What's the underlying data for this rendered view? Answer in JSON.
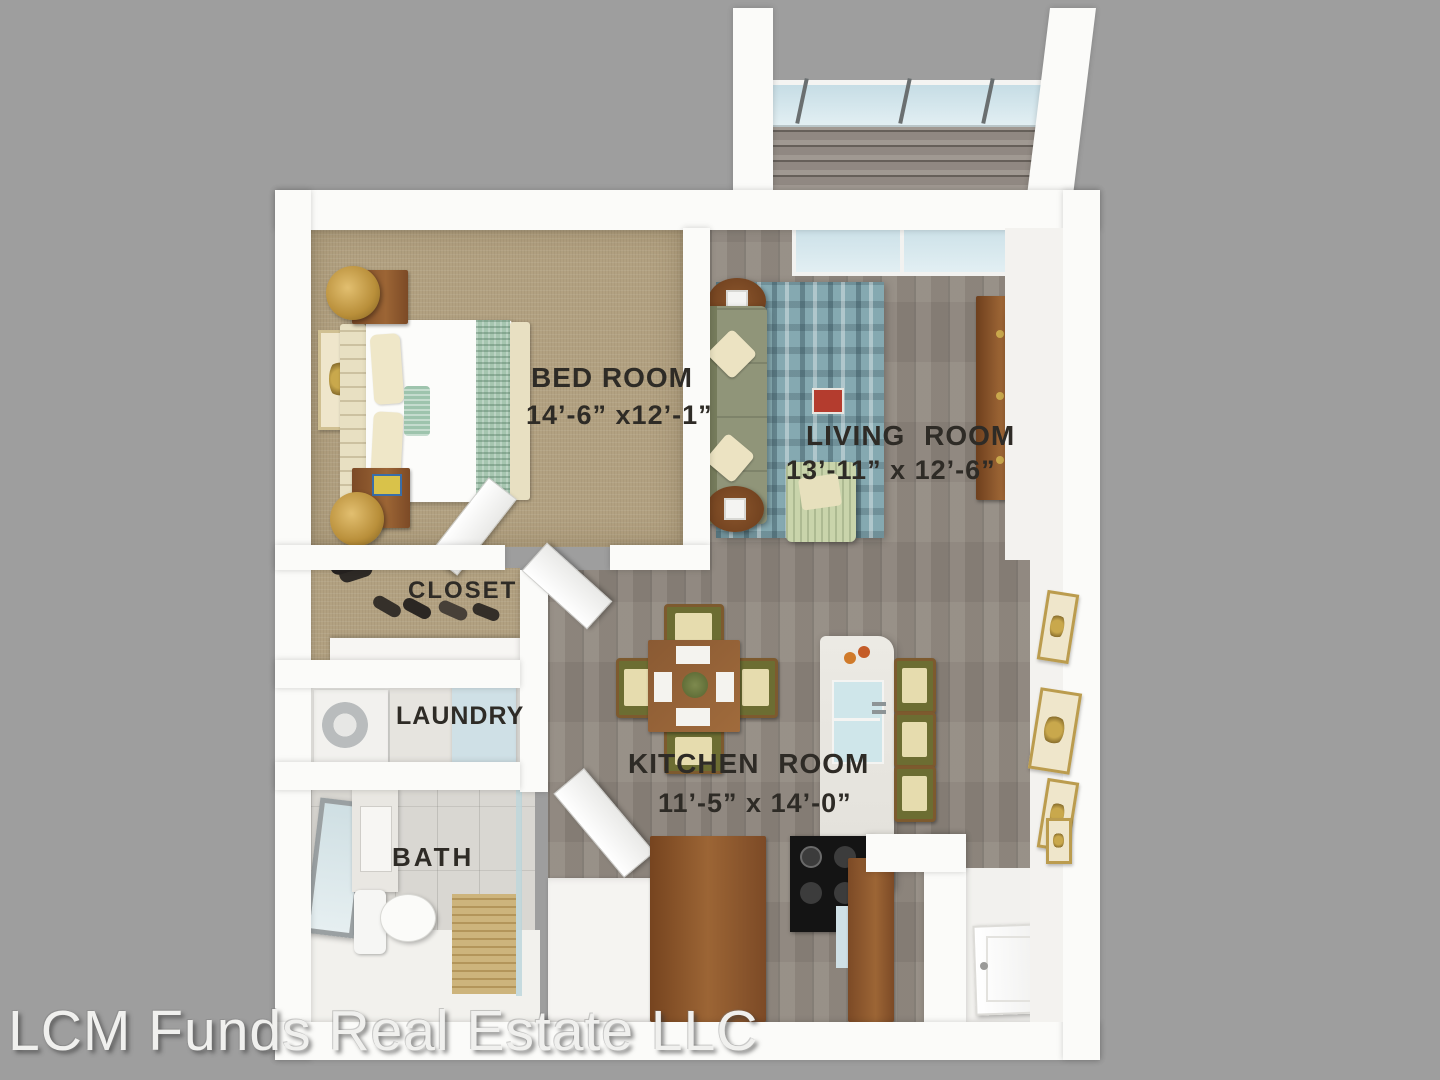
{
  "watermark": {
    "text": "LCM Funds Real Estate LLC"
  },
  "rooms": {
    "bedroom": {
      "label": "BED ROOM",
      "dimensions": "14’-6” x12’-1”"
    },
    "living": {
      "label": "LIVING ROOM",
      "dimensions": "13’-11” x 12’-6”"
    },
    "closet": {
      "label": "CLOSET"
    },
    "laundry": {
      "label": "LAUNDRY"
    },
    "bath": {
      "label": "BATH"
    },
    "kitchen": {
      "label": "KITCHEN ROOM",
      "dimensions": "11’-5” x 14’-0”"
    }
  },
  "colors": {
    "background": "#9e9e9e",
    "wall_white": "#fbfbf9",
    "carpet_tan": "#b2a181",
    "wood_floor_gray": "#8f877e",
    "balcony_deck": "#99918a",
    "bath_tile": "#d9d7d2",
    "rug_teal": "#85a9b1",
    "sofa_olive": "#8e9377",
    "chair_olive": "#6c6d32",
    "cabinet_brown": "#8a5a33",
    "island_marble": "#e9e7e1",
    "glass_blue": "#cde2e8",
    "tv_black": "#161616",
    "gold_accent": "#c9a84c",
    "label_text": "#2e2b26"
  }
}
